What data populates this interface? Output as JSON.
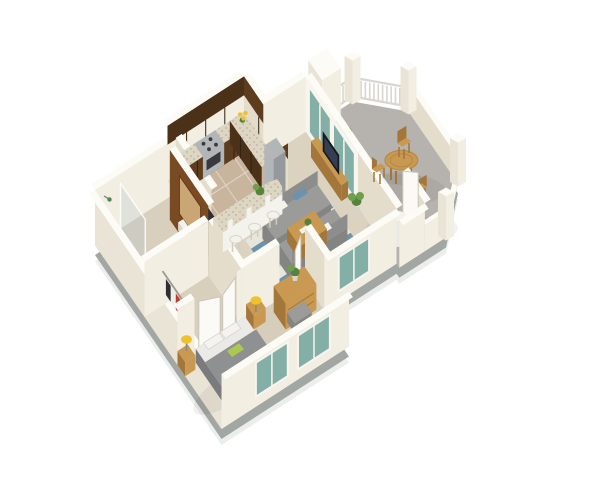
{
  "scene": {
    "type": "isometric-3d-floor-plan",
    "unit": "one-bedroom-one-bath-apartment-with-patio",
    "background": "#ffffff"
  },
  "colors": {
    "bg": "#ffffff",
    "slab_shadow": "#eceeec",
    "slab_side": "#a2a7a3",
    "floor_hall": "#d9cfbd",
    "floor_shower": "#cfc8b6",
    "floor_kitchen": "#c9b59d",
    "tile_grout": "rgba(255,255,255,0.45)",
    "floor_living": "#dcd2c0",
    "floor_bedroom": "#d7cdbb",
    "floor_patio": "#b6b3ae",
    "patch": "rgba(0,0,0,0.05)",
    "wall_se": "#f2eee1",
    "wall_sw": "#e4ddcc",
    "wall_outer": "#eae4d6",
    "wall_top": "#fcfbf6",
    "fence": "#d9d6cd",
    "cab_dark": "#4a3118",
    "cab_mid": "#5d3d1e",
    "cab_seam": "#33220f",
    "granite": "#ddd6c3",
    "steel": "#b3b6b8",
    "steel_dark": "#96999b",
    "oven": "#3a3a3e",
    "glass_teal": "#84afa6",
    "glass_frame": "#f7f5ee",
    "glass_shower": "rgba(176,200,204,0.3)",
    "accent_brown": "#7a4a22",
    "mirror": "#c9a674",
    "appliance": "#2e2e34",
    "appliance_face": "#232327",
    "white_fixture": "#f4f2ec",
    "fixture_shade": "#dcd8ce",
    "door_white": "#fbfaf6",
    "door_edge": "#c9c5b8",
    "rod": "#9a9890",
    "cloth_dark": "#2e2e34",
    "cloth_red": "#c23b2e",
    "cloth_white": "#efeee8",
    "rug_base": "#e8e5db",
    "rug_blue": "#6b93ad",
    "rug_blue_light": "#a8c0cf",
    "sofa": "#9b9c9a",
    "sofa_dark": "#848583",
    "sofa_back": "#8d8e8c",
    "pillow_white": "#f4f3ef",
    "throw_green": "#a9c94f",
    "bed_gray": "#8f9092",
    "bed_dark": "#7a7b7d",
    "bed_side": "#6f7072",
    "sheet_white": "#eceae6",
    "wood": "#c99851",
    "wood_dark": "#a3763a",
    "lamp_yellow": "#eec12d",
    "lamp_stem": "#8a8a86",
    "plant_green": "#55823c",
    "plant_green_light": "#6f9f4d",
    "pot": "#d8d3c6",
    "heater": "#ebe9e3",
    "tv_black": "#17171d",
    "tv_screen": "#324052",
    "shower_head": "#4a8a50",
    "stool_leg": "#cfccc2"
  },
  "rooms": {
    "bathroom": {
      "items": [
        "shower",
        "toilet",
        "pedestal-sink",
        "accent-wall-mirror",
        "stacked-laundry"
      ]
    },
    "walk_in_closet": {
      "items": [
        "hanging-rod",
        "clothes",
        "double-doors"
      ]
    },
    "kitchen": {
      "items": [
        "upper-cabinets",
        "base-cabinets",
        "granite-counters",
        "range",
        "refrigerator",
        "flowers",
        "breakfast-bar",
        "bar-stools"
      ]
    },
    "living_room": {
      "items": [
        "sofas",
        "coffee-table",
        "area-rug",
        "tv-console",
        "tv",
        "sliding-glass-doors",
        "potted-plant"
      ]
    },
    "bedroom": {
      "items": [
        "bed",
        "nightstands",
        "table-lamps",
        "dresser",
        "armchair",
        "ottoman",
        "side-table",
        "windows"
      ]
    },
    "patio": {
      "items": [
        "dining-table",
        "folding-chairs",
        "potted-plants",
        "picket-fence",
        "stucco-walls",
        "storage-closet",
        "water-heater",
        "open-door"
      ]
    }
  }
}
